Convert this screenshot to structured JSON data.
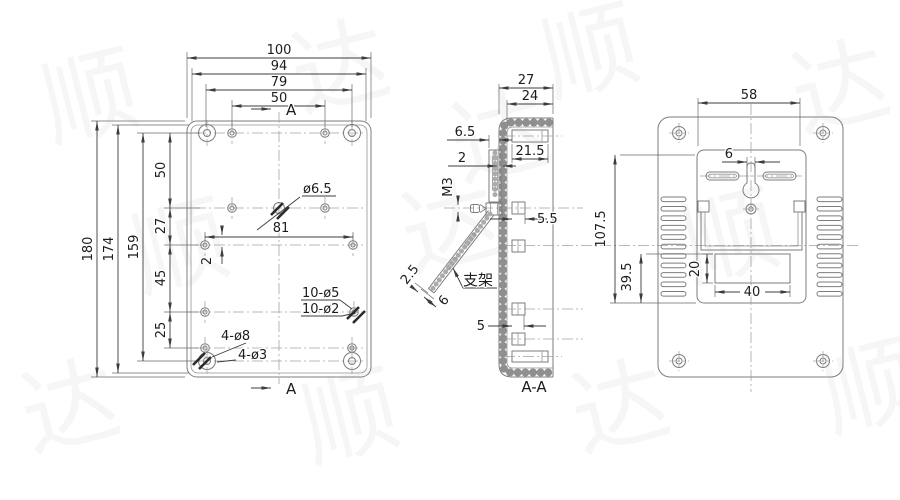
{
  "front": {
    "w100": "100",
    "w94": "94",
    "w79": "79",
    "w50": "50",
    "a_top": "A",
    "a_bottom": "A",
    "h180": "180",
    "h174": "174",
    "h159": "159",
    "s50": "50",
    "s27": "27",
    "s45": "45",
    "s25": "25",
    "d81": "81",
    "off2": "2",
    "center_hole": "ø6.5",
    "holes5": "10-ø5",
    "holes2": "10-ø2",
    "corner8": "4-ø8",
    "corner3": "4-ø3"
  },
  "section": {
    "w27": "27",
    "w24": "24",
    "d65": "6.5",
    "t2": "2",
    "d215": "21.5",
    "m3": "M3",
    "d55": "5.5",
    "bracket": "支架",
    "t25": "2.5",
    "len6": "6",
    "d5": "5",
    "label": "A-A"
  },
  "back": {
    "w58": "58",
    "slot6": "6",
    "h1075": "107.5",
    "h395": "39.5",
    "h20": "20",
    "w40": "40"
  },
  "watermark": {
    "text": "顺达"
  },
  "line_colors": {
    "geometry": "#7d7d7d",
    "dimension": "#3c3c3c",
    "centerline": "#a3a3a3"
  }
}
